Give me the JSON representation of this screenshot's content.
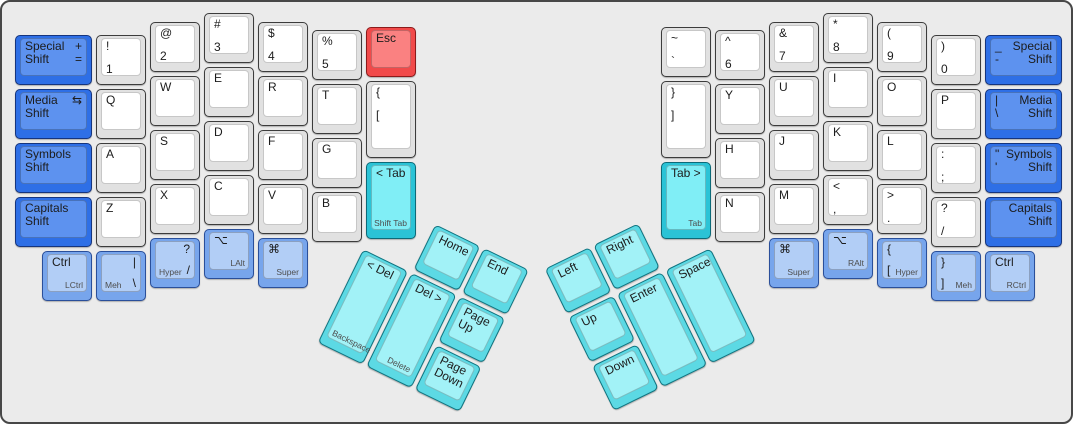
{
  "canvas": {
    "width": 1073,
    "height": 424
  },
  "panel": {
    "bg": "#ebebeb",
    "border": "#474747"
  },
  "palette": {
    "white": {
      "base": "#e1e1e1",
      "top": "#ffffff",
      "border": "#3c3c3c"
    },
    "shift": {
      "base": "#2e6fe6",
      "top": "#5d92ef",
      "border": "#16357e"
    },
    "mod": {
      "base": "#77a5ec",
      "top": "#b2cef6",
      "border": "#2a4f9a"
    },
    "tab": {
      "base": "#2bc3d6",
      "top": "#80eef6",
      "border": "#0d6a78"
    },
    "thumb": {
      "base": "#5cd9e4",
      "top": "#a2f2f7",
      "border": "#0f7480"
    },
    "esc": {
      "base": "#f14a4a",
      "top": "#fa8181",
      "border": "#8c1b1b"
    }
  },
  "groups": [
    {
      "name": "left-main-block",
      "x": 0,
      "y": 0,
      "rot": 0,
      "keys": [
        {
          "id": "special-shift-left",
          "x": 11,
          "y": 31,
          "w": 81,
          "style": "shift",
          "tl": [
            "Special",
            "Shift"
          ],
          "tr": [
            "+",
            "="
          ]
        },
        {
          "id": "media-shift-left",
          "x": 11,
          "y": 85,
          "w": 81,
          "style": "shift",
          "tl": [
            "Media",
            "Shift"
          ],
          "tr": [
            "⇆"
          ]
        },
        {
          "id": "symbols-shift-left",
          "x": 11,
          "y": 139,
          "w": 81,
          "style": "shift",
          "tl": [
            "Symbols",
            "Shift"
          ]
        },
        {
          "id": "capitals-shift-left",
          "x": 11,
          "y": 193,
          "w": 81,
          "style": "shift",
          "tl": [
            "Capitals",
            "Shift"
          ]
        },
        {
          "id": "num1",
          "x": 92,
          "y": 31,
          "style": "white",
          "tl": [
            "!"
          ],
          "ml": [
            "1"
          ]
        },
        {
          "id": "q",
          "x": 92,
          "y": 85,
          "style": "white",
          "tl": [
            "Q"
          ]
        },
        {
          "id": "a",
          "x": 92,
          "y": 139,
          "style": "white",
          "tl": [
            "A"
          ]
        },
        {
          "id": "z",
          "x": 92,
          "y": 193,
          "style": "white",
          "tl": [
            "Z"
          ]
        },
        {
          "id": "num2",
          "x": 146,
          "y": 18,
          "style": "white",
          "tl": [
            "@"
          ],
          "ml": [
            "2"
          ]
        },
        {
          "id": "w",
          "x": 146,
          "y": 72,
          "style": "white",
          "tl": [
            "W"
          ]
        },
        {
          "id": "s",
          "x": 146,
          "y": 126,
          "style": "white",
          "tl": [
            "S"
          ]
        },
        {
          "id": "x",
          "x": 146,
          "y": 180,
          "style": "white",
          "tl": [
            "X"
          ]
        },
        {
          "id": "num3",
          "x": 200,
          "y": 9,
          "style": "white",
          "tl": [
            "#"
          ],
          "ml": [
            "3"
          ]
        },
        {
          "id": "e",
          "x": 200,
          "y": 63,
          "style": "white",
          "tl": [
            "E"
          ]
        },
        {
          "id": "d",
          "x": 200,
          "y": 117,
          "style": "white",
          "tl": [
            "D"
          ]
        },
        {
          "id": "c",
          "x": 200,
          "y": 171,
          "style": "white",
          "tl": [
            "C"
          ]
        },
        {
          "id": "num4",
          "x": 254,
          "y": 18,
          "style": "white",
          "tl": [
            "$"
          ],
          "ml": [
            "4"
          ]
        },
        {
          "id": "r",
          "x": 254,
          "y": 72,
          "style": "white",
          "tl": [
            "R"
          ]
        },
        {
          "id": "f",
          "x": 254,
          "y": 126,
          "style": "white",
          "tl": [
            "F"
          ]
        },
        {
          "id": "v",
          "x": 254,
          "y": 180,
          "style": "white",
          "tl": [
            "V"
          ]
        },
        {
          "id": "num5",
          "x": 308,
          "y": 26,
          "style": "white",
          "tl": [
            "%"
          ],
          "ml": [
            "5"
          ]
        },
        {
          "id": "t",
          "x": 308,
          "y": 80,
          "style": "white",
          "tl": [
            "T"
          ]
        },
        {
          "id": "g",
          "x": 308,
          "y": 134,
          "style": "white",
          "tl": [
            "G"
          ]
        },
        {
          "id": "b",
          "x": 308,
          "y": 188,
          "style": "white",
          "tl": [
            "B"
          ]
        },
        {
          "id": "esc",
          "x": 362,
          "y": 23,
          "style": "esc",
          "tl": [
            "Esc"
          ]
        },
        {
          "id": "brace-left",
          "x": 362,
          "y": 77,
          "h": 81,
          "style": "white",
          "tl": [
            "{"
          ],
          "ml": [
            "["
          ]
        },
        {
          "id": "tab-left",
          "x": 362,
          "y": 158,
          "h": 81,
          "style": "tab",
          "tl": [
            "< Tab"
          ],
          "sr": "Shift Tab"
        },
        {
          "id": "lctrl",
          "x": 38,
          "y": 247,
          "style": "mod",
          "tl": [
            "Ctrl"
          ],
          "sr": "LCtrl"
        },
        {
          "id": "meh-left",
          "x": 92,
          "y": 247,
          "style": "mod",
          "tr": [
            "|"
          ],
          "br": [
            "\\"
          ],
          "sl": "Meh"
        },
        {
          "id": "hyper-left",
          "x": 146,
          "y": 234,
          "style": "mod",
          "tr": [
            "?"
          ],
          "br": [
            "/"
          ],
          "sl": "Hyper"
        },
        {
          "id": "lalt",
          "x": 200,
          "y": 225,
          "style": "mod",
          "tl": [
            "⌥"
          ],
          "sr": "LAlt"
        },
        {
          "id": "super-left",
          "x": 254,
          "y": 234,
          "style": "mod",
          "tl": [
            "⌘"
          ],
          "sr": "Super"
        }
      ]
    },
    {
      "name": "left-thumb-cluster",
      "x": 384,
      "y": 196,
      "rot": 26,
      "keys": [
        {
          "id": "home",
          "x": 54,
          "y": 0,
          "style": "thumb",
          "tl": [
            "Home"
          ]
        },
        {
          "id": "end",
          "x": 108,
          "y": 0,
          "style": "thumb",
          "tl": [
            "End"
          ]
        },
        {
          "id": "backspace",
          "x": 0,
          "y": 54,
          "h": 108,
          "style": "thumb",
          "tl": [
            "< Del"
          ],
          "sl": "Backspace"
        },
        {
          "id": "delete",
          "x": 54,
          "y": 54,
          "h": 108,
          "style": "thumb",
          "tl": [
            "Del >"
          ],
          "sr": "Delete"
        },
        {
          "id": "page-up",
          "x": 108,
          "y": 54,
          "style": "thumb",
          "tl": [
            "Page",
            "Up"
          ]
        },
        {
          "id": "page-down",
          "x": 108,
          "y": 108,
          "style": "thumb",
          "tl": [
            "Page",
            "Down"
          ]
        }
      ]
    },
    {
      "name": "right-thumb-cluster",
      "x": 540,
      "y": 266,
      "rot": -26,
      "keys": [
        {
          "id": "left",
          "x": 0,
          "y": 0,
          "style": "thumb",
          "tl": [
            "Left"
          ]
        },
        {
          "id": "right",
          "x": 54,
          "y": 0,
          "style": "thumb",
          "tl": [
            "Right"
          ]
        },
        {
          "id": "up",
          "x": 0,
          "y": 54,
          "style": "thumb",
          "tl": [
            "Up"
          ]
        },
        {
          "id": "enter",
          "x": 54,
          "y": 54,
          "h": 108,
          "style": "thumb",
          "tl": [
            "Enter"
          ]
        },
        {
          "id": "space",
          "x": 108,
          "y": 54,
          "h": 108,
          "style": "thumb",
          "tl": [
            "Space"
          ]
        },
        {
          "id": "down",
          "x": 0,
          "y": 108,
          "style": "thumb",
          "tl": [
            "Down"
          ]
        }
      ]
    },
    {
      "name": "right-main-block",
      "x": 0,
      "y": 0,
      "rot": 0,
      "keys": [
        {
          "id": "backtick",
          "x": 657,
          "y": 23,
          "style": "white",
          "tl": [
            "~"
          ],
          "ml": [
            "`"
          ]
        },
        {
          "id": "brace-right",
          "x": 657,
          "y": 77,
          "h": 81,
          "style": "white",
          "tl": [
            "}"
          ],
          "ml": [
            "]"
          ]
        },
        {
          "id": "tab-right",
          "x": 657,
          "y": 158,
          "h": 81,
          "style": "tab",
          "tl": [
            "Tab >"
          ],
          "sr": "Tab"
        },
        {
          "id": "num6",
          "x": 711,
          "y": 26,
          "style": "white",
          "tl": [
            "^"
          ],
          "ml": [
            "6"
          ]
        },
        {
          "id": "y",
          "x": 711,
          "y": 80,
          "style": "white",
          "tl": [
            "Y"
          ]
        },
        {
          "id": "h",
          "x": 711,
          "y": 134,
          "style": "white",
          "tl": [
            "H"
          ]
        },
        {
          "id": "n",
          "x": 711,
          "y": 188,
          "style": "white",
          "tl": [
            "N"
          ]
        },
        {
          "id": "num7",
          "x": 765,
          "y": 18,
          "style": "white",
          "tl": [
            "&"
          ],
          "ml": [
            "7"
          ]
        },
        {
          "id": "u",
          "x": 765,
          "y": 72,
          "style": "white",
          "tl": [
            "U"
          ]
        },
        {
          "id": "j",
          "x": 765,
          "y": 126,
          "style": "white",
          "tl": [
            "J"
          ]
        },
        {
          "id": "m",
          "x": 765,
          "y": 180,
          "style": "white",
          "tl": [
            "M"
          ]
        },
        {
          "id": "num8",
          "x": 819,
          "y": 9,
          "style": "white",
          "tl": [
            "*"
          ],
          "ml": [
            "8"
          ]
        },
        {
          "id": "i",
          "x": 819,
          "y": 63,
          "style": "white",
          "tl": [
            "I"
          ]
        },
        {
          "id": "k",
          "x": 819,
          "y": 117,
          "style": "white",
          "tl": [
            "K"
          ]
        },
        {
          "id": "comma",
          "x": 819,
          "y": 171,
          "style": "white",
          "tl": [
            "<"
          ],
          "ml": [
            ","
          ]
        },
        {
          "id": "num9",
          "x": 873,
          "y": 18,
          "style": "white",
          "tl": [
            "("
          ],
          "ml": [
            "9"
          ]
        },
        {
          "id": "o",
          "x": 873,
          "y": 72,
          "style": "white",
          "tl": [
            "O"
          ]
        },
        {
          "id": "l",
          "x": 873,
          "y": 126,
          "style": "white",
          "tl": [
            "L"
          ]
        },
        {
          "id": "period",
          "x": 873,
          "y": 180,
          "style": "white",
          "tl": [
            ">"
          ],
          "ml": [
            "."
          ]
        },
        {
          "id": "num0",
          "x": 927,
          "y": 31,
          "style": "white",
          "tl": [
            ")"
          ],
          "ml": [
            "0"
          ]
        },
        {
          "id": "p",
          "x": 927,
          "y": 85,
          "style": "white",
          "tl": [
            "P"
          ]
        },
        {
          "id": "semicolon",
          "x": 927,
          "y": 139,
          "style": "white",
          "tl": [
            ":"
          ],
          "ml": [
            ";"
          ]
        },
        {
          "id": "slash",
          "x": 927,
          "y": 193,
          "style": "white",
          "tl": [
            "?"
          ],
          "ml": [
            "/"
          ]
        },
        {
          "id": "special-shift-right",
          "x": 981,
          "y": 31,
          "w": 81,
          "style": "shift",
          "tr": [
            "Special",
            "Shift"
          ],
          "tl": [
            "_",
            "-"
          ]
        },
        {
          "id": "media-shift-right",
          "x": 981,
          "y": 85,
          "w": 81,
          "style": "shift",
          "tr": [
            "Media",
            "Shift"
          ],
          "tl": [
            "|",
            "\\"
          ]
        },
        {
          "id": "symbols-shift-right",
          "x": 981,
          "y": 139,
          "w": 81,
          "style": "shift",
          "tr": [
            "Symbols",
            "Shift"
          ],
          "tl": [
            "\"",
            "'"
          ]
        },
        {
          "id": "capitals-shift-right",
          "x": 981,
          "y": 193,
          "w": 81,
          "style": "shift",
          "tr": [
            "Capitals",
            "Shift"
          ]
        },
        {
          "id": "super-right",
          "x": 765,
          "y": 234,
          "style": "mod",
          "tl": [
            "⌘"
          ],
          "sr": "Super"
        },
        {
          "id": "ralt",
          "x": 819,
          "y": 225,
          "style": "mod",
          "tl": [
            "⌥"
          ],
          "sr": "RAlt"
        },
        {
          "id": "hyper-right",
          "x": 873,
          "y": 234,
          "style": "mod",
          "tl": [
            "{"
          ],
          "bl": [
            "["
          ],
          "sr": "Hyper"
        },
        {
          "id": "meh-right",
          "x": 927,
          "y": 247,
          "style": "mod",
          "tl": [
            "}"
          ],
          "bl": [
            "]"
          ],
          "sr": "Meh"
        },
        {
          "id": "rctrl",
          "x": 981,
          "y": 247,
          "style": "mod",
          "tl": [
            "Ctrl"
          ],
          "sr": "RCtrl"
        }
      ]
    }
  ]
}
